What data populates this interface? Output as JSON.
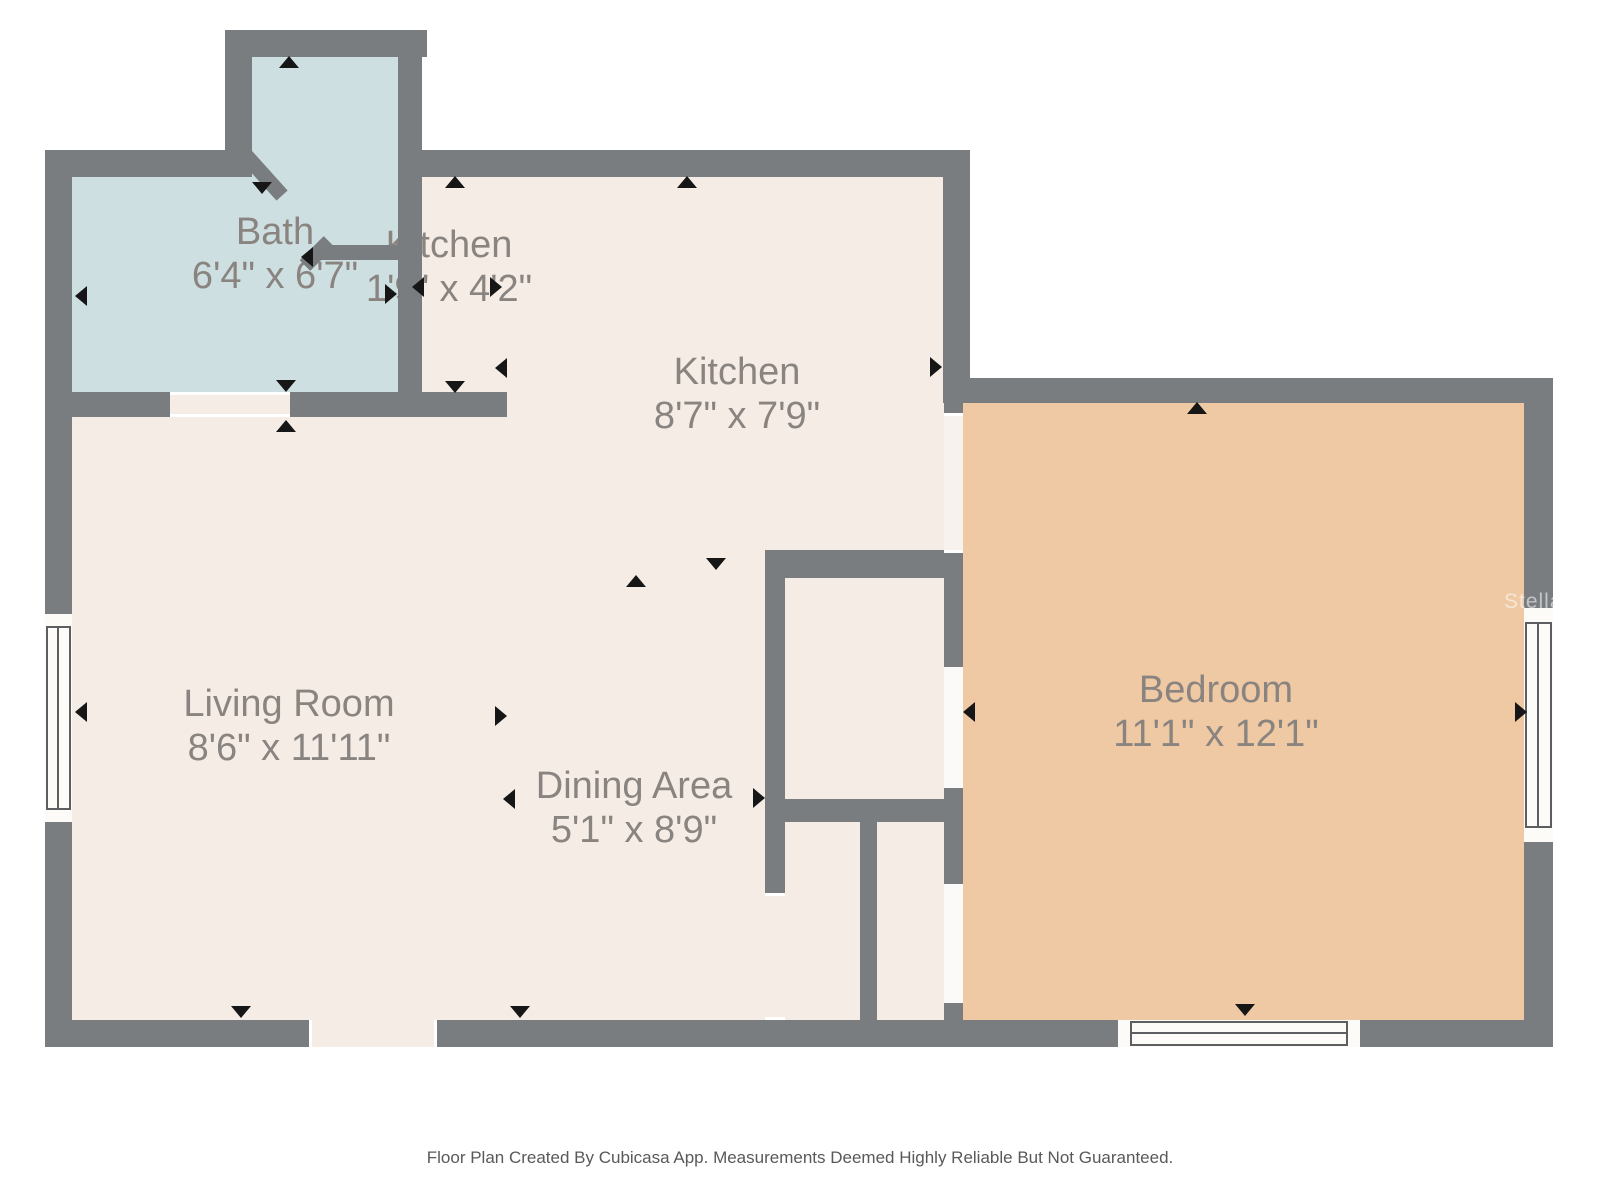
{
  "plan": {
    "rooms": [
      {
        "name": "Bath",
        "dims": "6'4\" x 6'7\""
      },
      {
        "name": "Kitchen",
        "dims": "1'9\" x 4'2\""
      },
      {
        "name": "Kitchen",
        "dims": "8'7\" x 7'9\""
      },
      {
        "name": "Living Room",
        "dims": "8'6\" x 11'11\""
      },
      {
        "name": "Dining Area",
        "dims": "5'1\" x 8'9\""
      },
      {
        "name": "Bedroom",
        "dims": "11'1\" x 12'1\""
      }
    ],
    "watermark": "StellarMLS",
    "footer": "Floor Plan Created By Cubicasa App. Measurements Deemed Highly Reliable But Not Guaranteed.",
    "colors": {
      "wall": "#7a7d80",
      "floor": "#f5ece6",
      "bath-floor": "#cddfe0",
      "bedroom-floor": "#eec9a3",
      "opening": "#f7f2ee",
      "label": "#8a8480",
      "marker": "#161616",
      "footer-text": "#59595b",
      "watermark-text": "#ffffff"
    }
  }
}
